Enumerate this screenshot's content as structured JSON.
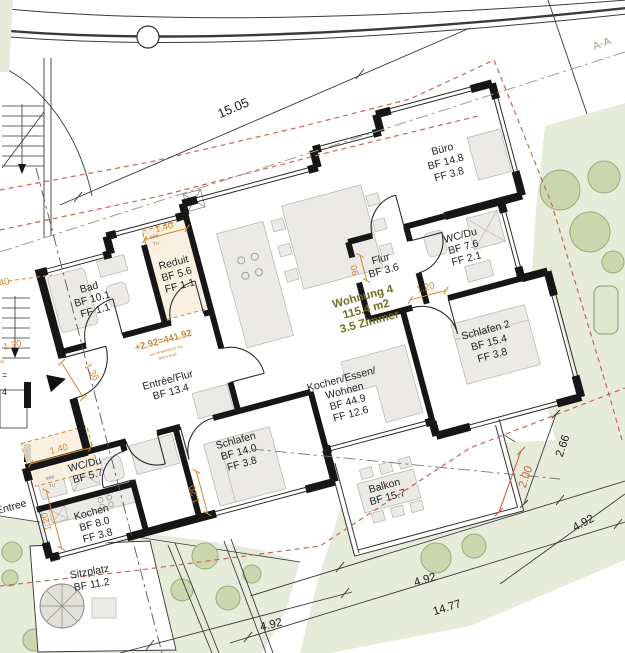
{
  "unit": {
    "name": "Wohnung 4",
    "area": "115.4 m2",
    "rooms": "3.5 Zimmer"
  },
  "rooms": [
    {
      "name": "Büro",
      "bf": "BF 14.8",
      "ff": "FF 3.8"
    },
    {
      "name": "WC/Du",
      "bf": "BF 7.6",
      "ff": "FF 2.1"
    },
    {
      "name": "Flur",
      "bf": "BF 3.6"
    },
    {
      "name": "Schlafen 2",
      "bf": "BF 15.4",
      "ff": "FF 3.8"
    },
    {
      "name": "Bad",
      "bf": "BF 10.1",
      "ff": "FF 1.1"
    },
    {
      "name": "Reduit",
      "bf": "BF 5.6",
      "ff": "FF 1.1"
    },
    {
      "name": "Entrée/Flur",
      "bf": "BF 13.4"
    },
    {
      "name_line1": "Kochen/Essen/",
      "name_line2": "Wohnen",
      "bf": "BF 44.9",
      "ff": "FF 12.6"
    },
    {
      "name": "WC/Du",
      "bf": "BF 5.7"
    },
    {
      "name": "Schlafen",
      "bf": "BF 14.0",
      "ff": "FF 3.8"
    },
    {
      "name": "Kochen",
      "bf": "BF 8.0",
      "ff": "FF 3.8"
    },
    {
      "name": "Balkon",
      "bf": "BF 15.7"
    },
    {
      "name": "Sitzplatz",
      "bf": "BF 11.2"
    },
    {
      "name": "Entree"
    }
  ],
  "dimensions": {
    "facade": "15.05",
    "balcony_depth": "2.66",
    "balcony_red": "2.00",
    "garden_right": "4.92",
    "garden_bottom": "4.92",
    "garden_total": "14.77",
    "garden_left": "4.92",
    "reduit_width": "1.40",
    "zone_width": "1.40",
    "entry_door": "1.36",
    "kochen_width": "1.20",
    "schlafen_width": "1.20",
    "flur_door": "1.20",
    "flur_width": "90",
    "edge_a": "1.20",
    "edge_b": "1.40"
  },
  "annotations": {
    "level": "+2.92=441.92",
    "note1": "als hinweistext mit",
    "note2": "6font brail",
    "section": "A-A",
    "eq": "=",
    "four": "4",
    "wm": "WM",
    "tu": "TU"
  }
}
